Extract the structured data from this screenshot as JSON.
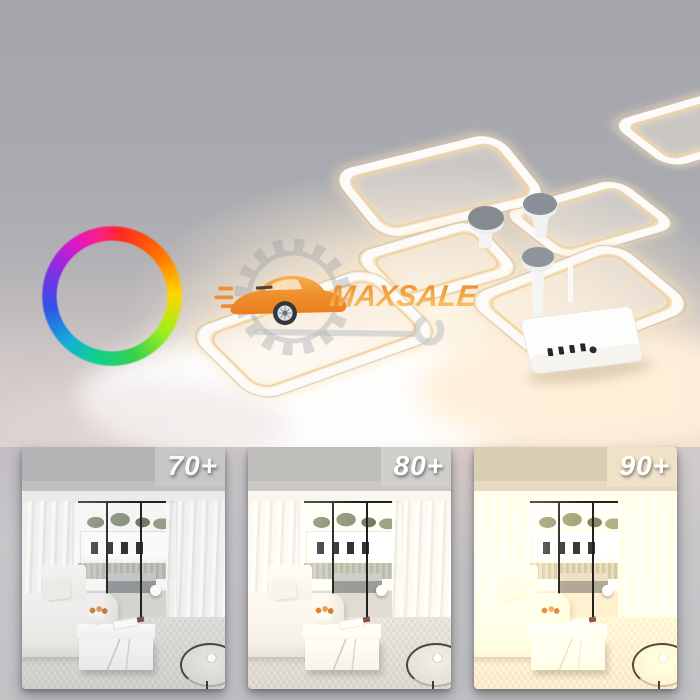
{
  "brand_watermark": {
    "text": "MAXSALE"
  },
  "thumbnails": [
    {
      "label": "70+"
    },
    {
      "label": "80+"
    },
    {
      "label": "90+"
    }
  ],
  "icons": {
    "rgb_ring": "rgb-color-wheel",
    "gear": "gear-cog",
    "car": "sports-car",
    "wrench": "wrench"
  },
  "colors": {
    "brand_orange": "#ef9930",
    "warm_light": "#fcecd2",
    "label_text": "#ffffff",
    "ceiling_gray": "#a8aaaf"
  }
}
